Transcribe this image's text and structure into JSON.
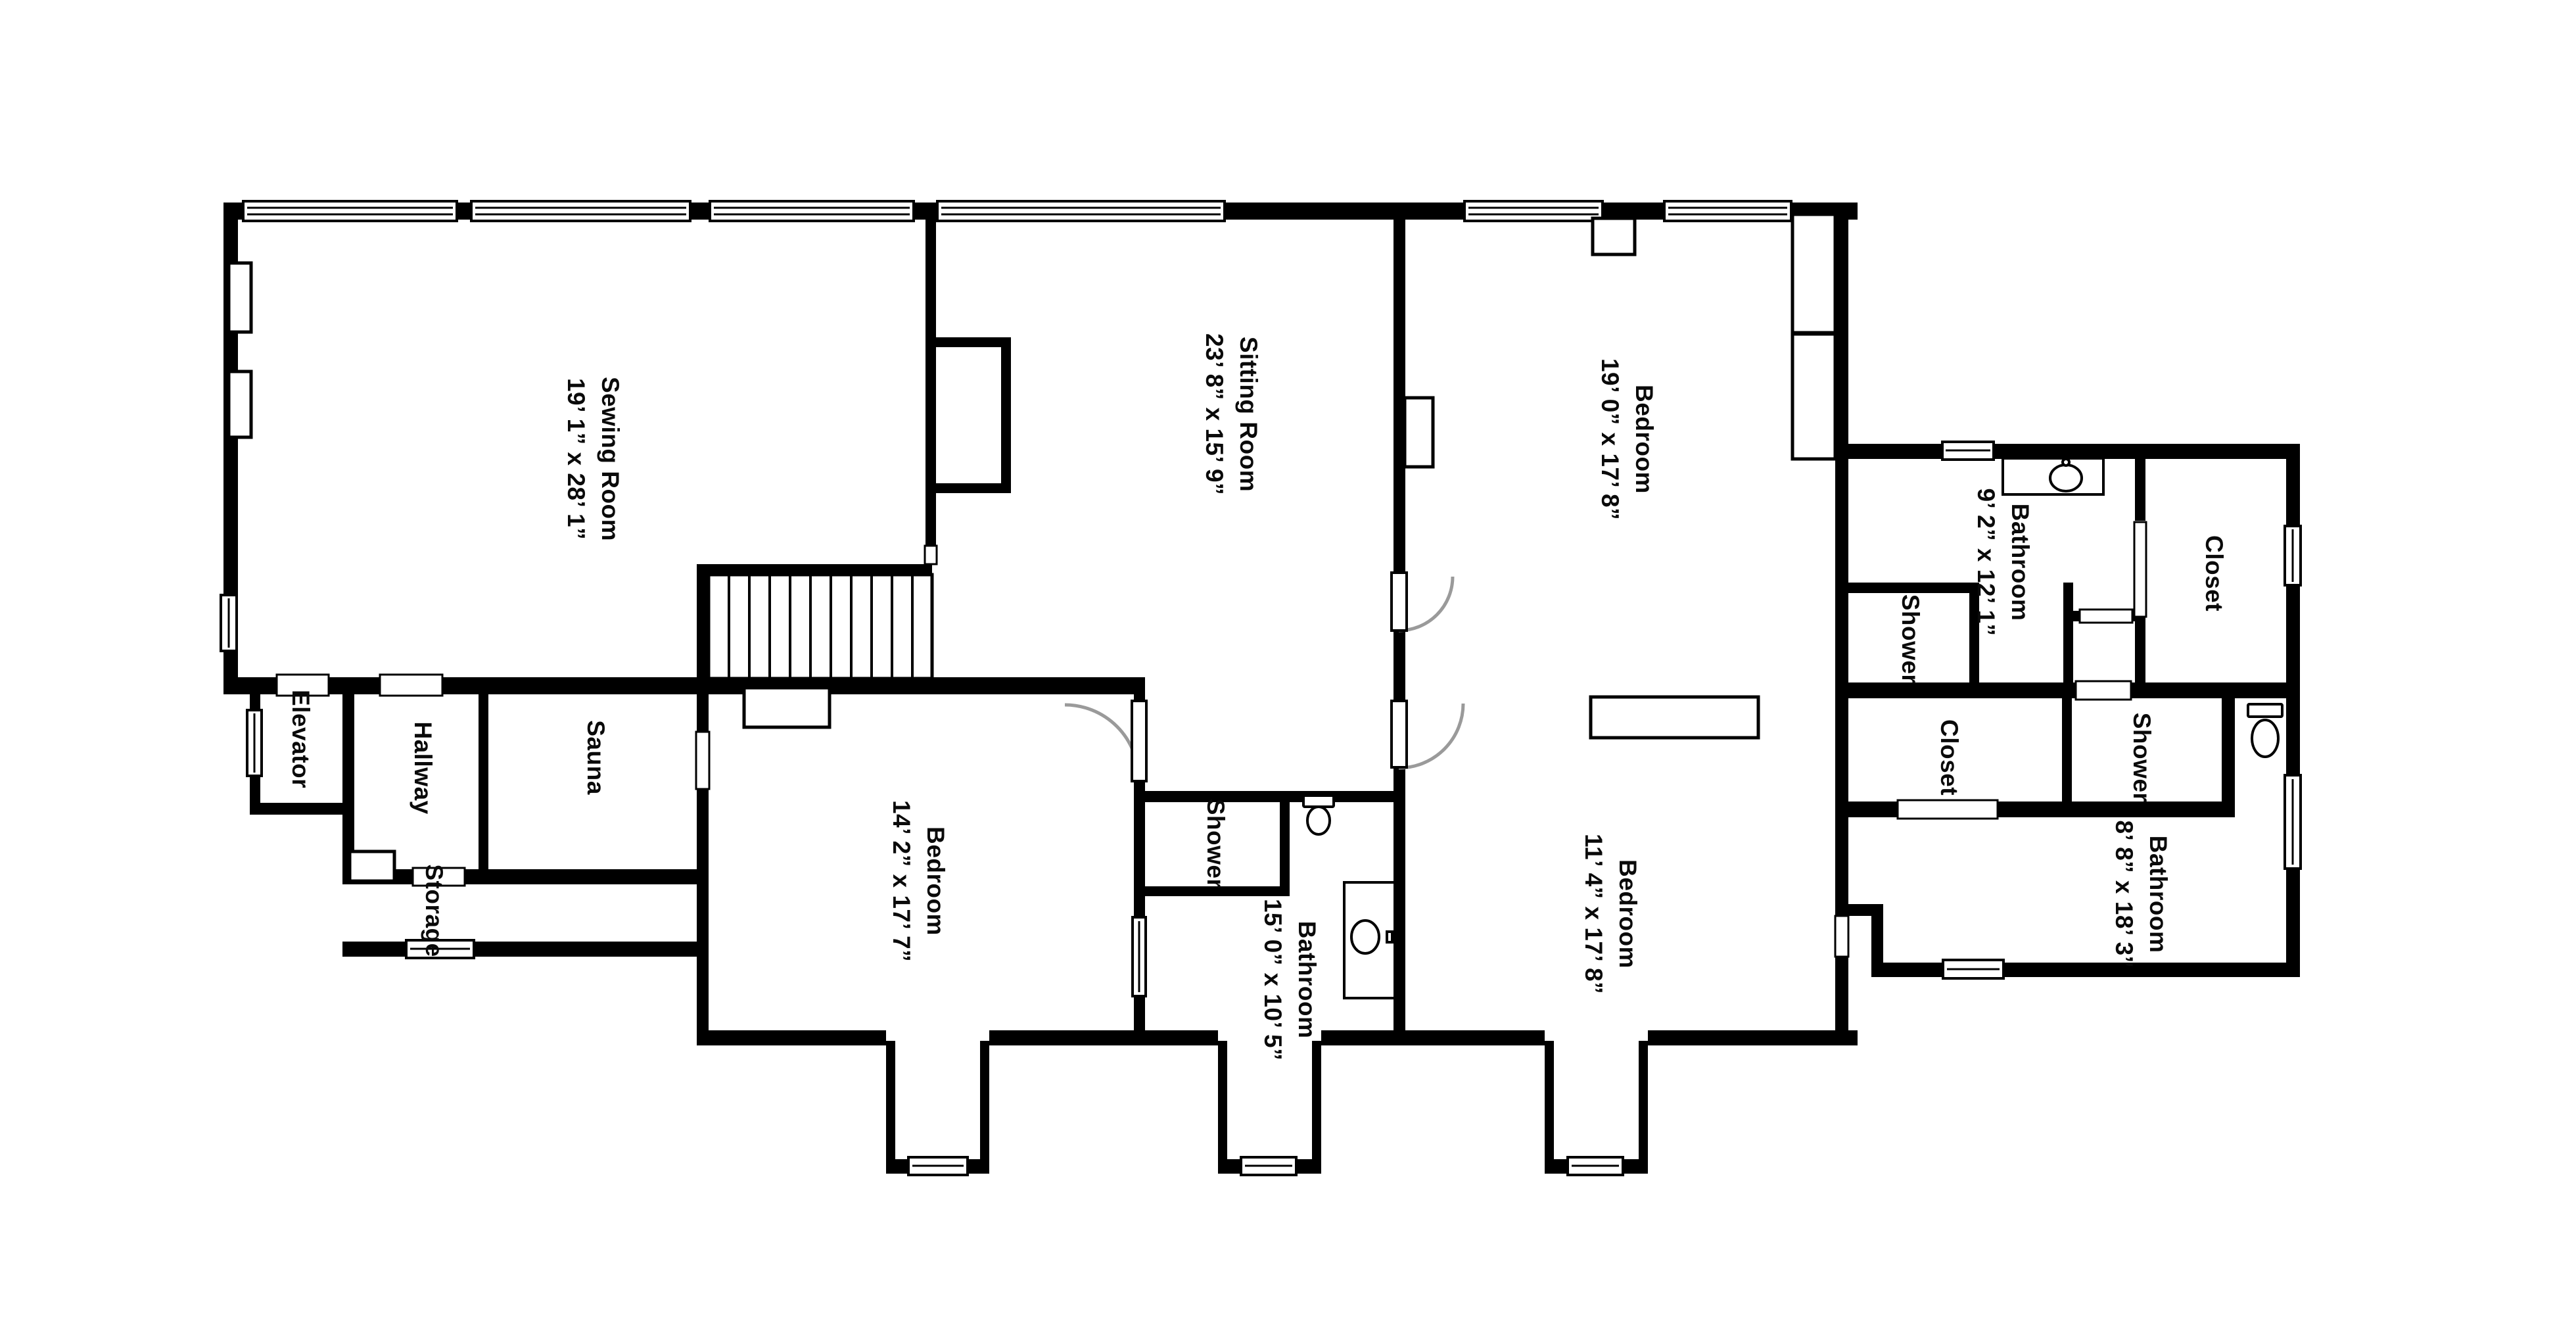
{
  "document_title": "Floor Plan",
  "rooms": {
    "sewing": {
      "name": "Sewing Room",
      "dims": "19’ 1” x 28’ 1”"
    },
    "sitting": {
      "name": "Sitting Room",
      "dims": "23’ 8” x 15’ 9”"
    },
    "bedroom_top_right": {
      "name": "Bedroom",
      "dims": "19’ 0” x 17’ 8”"
    },
    "bathroom_top_right": {
      "name": "Bathroom",
      "dims": "9’ 2” x 12’ 1”"
    },
    "closet_top_right": {
      "name": "Closet"
    },
    "shower_top_right": {
      "name": "Shower"
    },
    "elevator": {
      "name": "Elevator"
    },
    "hallway": {
      "name": "Hallway"
    },
    "sauna": {
      "name": "Sauna"
    },
    "storage": {
      "name": "Storage"
    },
    "bedroom_bottom_left": {
      "name": "Bedroom",
      "dims": "14’ 2” x 17’ 7”"
    },
    "shower_middle": {
      "name": "Shower"
    },
    "bathroom_middle": {
      "name": "Bathroom",
      "dims": "15’ 0” x 10’ 5”"
    },
    "bedroom_bottom_right": {
      "name": "Bedroom",
      "dims": "11’ 4” x 17’ 8”"
    },
    "closet_bottom_right": {
      "name": "Closet"
    },
    "shower_bottom_right": {
      "name": "Shower"
    },
    "bathroom_bottom_right": {
      "name": "Bathroom",
      "dims": "8’ 8” x 18’ 3”"
    }
  },
  "colors": {
    "wall": "#000000",
    "floor": "#ffffff",
    "door_arc": "#9a9a9a"
  }
}
